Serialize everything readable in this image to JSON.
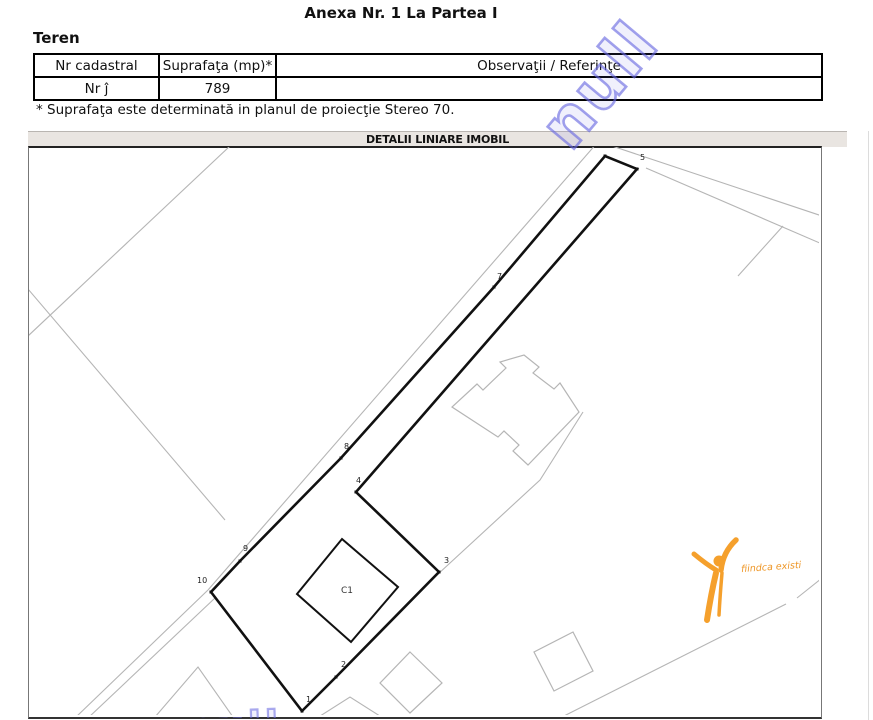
{
  "header": {
    "title": "Anexa Nr. 1 La Partea I",
    "section": "Teren"
  },
  "table": {
    "columns": [
      "Nr cadastral",
      "Suprafaţa (mp)*",
      "Observaţii / Referinţe"
    ],
    "row": {
      "nr": "Nr ĵ",
      "suprafata": "789",
      "observatii": ""
    }
  },
  "footnote": "* Suprafaţa este determinată in planul de proiecţie Stereo 70.",
  "colors": {
    "watermark_blue": "#6868e0",
    "logo_orange": "#f5a02c",
    "map_line_gray": "#b5b5b5",
    "parcel_black": "#111111",
    "bar_bg": "#e9e5e1"
  },
  "map": {
    "title": "DETALII LINIARE IMOBIL",
    "watermark": {
      "text": "null"
    },
    "logo": {
      "text": "fiindca existi"
    },
    "parcel": {
      "stroke": "#111111",
      "vertices": [
        {
          "label": "1",
          "x": 302,
          "y": 711,
          "lx": 306,
          "ly": 702
        },
        {
          "label": "2",
          "x": 336,
          "y": 677,
          "lx": 341,
          "ly": 667
        },
        {
          "label": "3",
          "x": 439,
          "y": 572,
          "lx": 444,
          "ly": 563
        },
        {
          "label": "4",
          "x": 356,
          "y": 492,
          "lx": 356,
          "ly": 483
        },
        {
          "label": "5",
          "x": 637,
          "y": 169,
          "lx": 640,
          "ly": 160
        },
        {
          "label": "6",
          "x": 605,
          "y": 156,
          "lx": 606,
          "ly": 147
        },
        {
          "label": "7",
          "x": 494,
          "y": 287,
          "lx": 497,
          "ly": 279
        },
        {
          "label": "8",
          "x": 341,
          "y": 458,
          "lx": 344,
          "ly": 449
        },
        {
          "label": "9",
          "x": 240,
          "y": 561,
          "lx": 243,
          "ly": 551
        },
        {
          "label": "10",
          "x": 211,
          "y": 592,
          "lx": 197,
          "ly": 583
        }
      ]
    },
    "building_c1": {
      "label": "C1",
      "points": [
        [
          342,
          539
        ],
        [
          398,
          587
        ],
        [
          351,
          642
        ],
        [
          297,
          594
        ]
      ],
      "label_x": 347,
      "label_y": 590
    },
    "background": {
      "stroke": "#b5b5b5",
      "lines": [
        [
          [
            230,
            146
          ],
          [
            28,
            336
          ]
        ],
        [
          [
            28,
            289
          ],
          [
            225,
            520
          ]
        ],
        [
          [
            597,
            143
          ],
          [
            208,
            590
          ]
        ],
        [
          [
            208,
            590
          ],
          [
            75,
            718
          ]
        ],
        [
          [
            215,
            598
          ],
          [
            88,
            718
          ]
        ],
        [
          [
            612,
            146
          ],
          [
            822,
            216
          ]
        ],
        [
          [
            646,
            168
          ],
          [
            822,
            244
          ]
        ],
        [
          [
            783,
            226
          ],
          [
            738,
            276
          ]
        ],
        [
          [
            583,
            412
          ],
          [
            540,
            480
          ],
          [
            437,
            575
          ],
          [
            430,
            582
          ]
        ],
        [
          [
            822,
            578
          ],
          [
            797,
            598
          ]
        ],
        [
          [
            786,
            604
          ],
          [
            560,
            718
          ]
        ],
        [
          [
            155,
            717
          ],
          [
            198,
            667
          ],
          [
            233,
            717
          ]
        ],
        [
          [
            317,
            718
          ],
          [
            350,
            697
          ],
          [
            383,
            718
          ]
        ]
      ],
      "polygons": [
        {
          "name": "house-footprint",
          "points": [
            [
              524,
              355
            ],
            [
              539,
              367
            ],
            [
              533,
              373
            ],
            [
              554,
              389
            ],
            [
              560,
              383
            ],
            [
              579,
              412
            ],
            [
              528,
              465
            ],
            [
              513,
              451
            ],
            [
              519,
              445
            ],
            [
              504,
              431
            ],
            [
              498,
              437
            ],
            [
              452,
              407
            ],
            [
              477,
              384
            ],
            [
              483,
              390
            ],
            [
              506,
              368
            ],
            [
              500,
              362
            ]
          ]
        },
        {
          "name": "parcel-diamond-1",
          "points": [
            [
              410,
              652
            ],
            [
              442,
              683
            ],
            [
              410,
              713
            ],
            [
              380,
              683
            ]
          ]
        },
        {
          "name": "parcel-diamond-2",
          "points": [
            [
              573,
              632
            ],
            [
              593,
              671
            ],
            [
              554,
              691
            ],
            [
              534,
              652
            ]
          ]
        }
      ]
    }
  }
}
